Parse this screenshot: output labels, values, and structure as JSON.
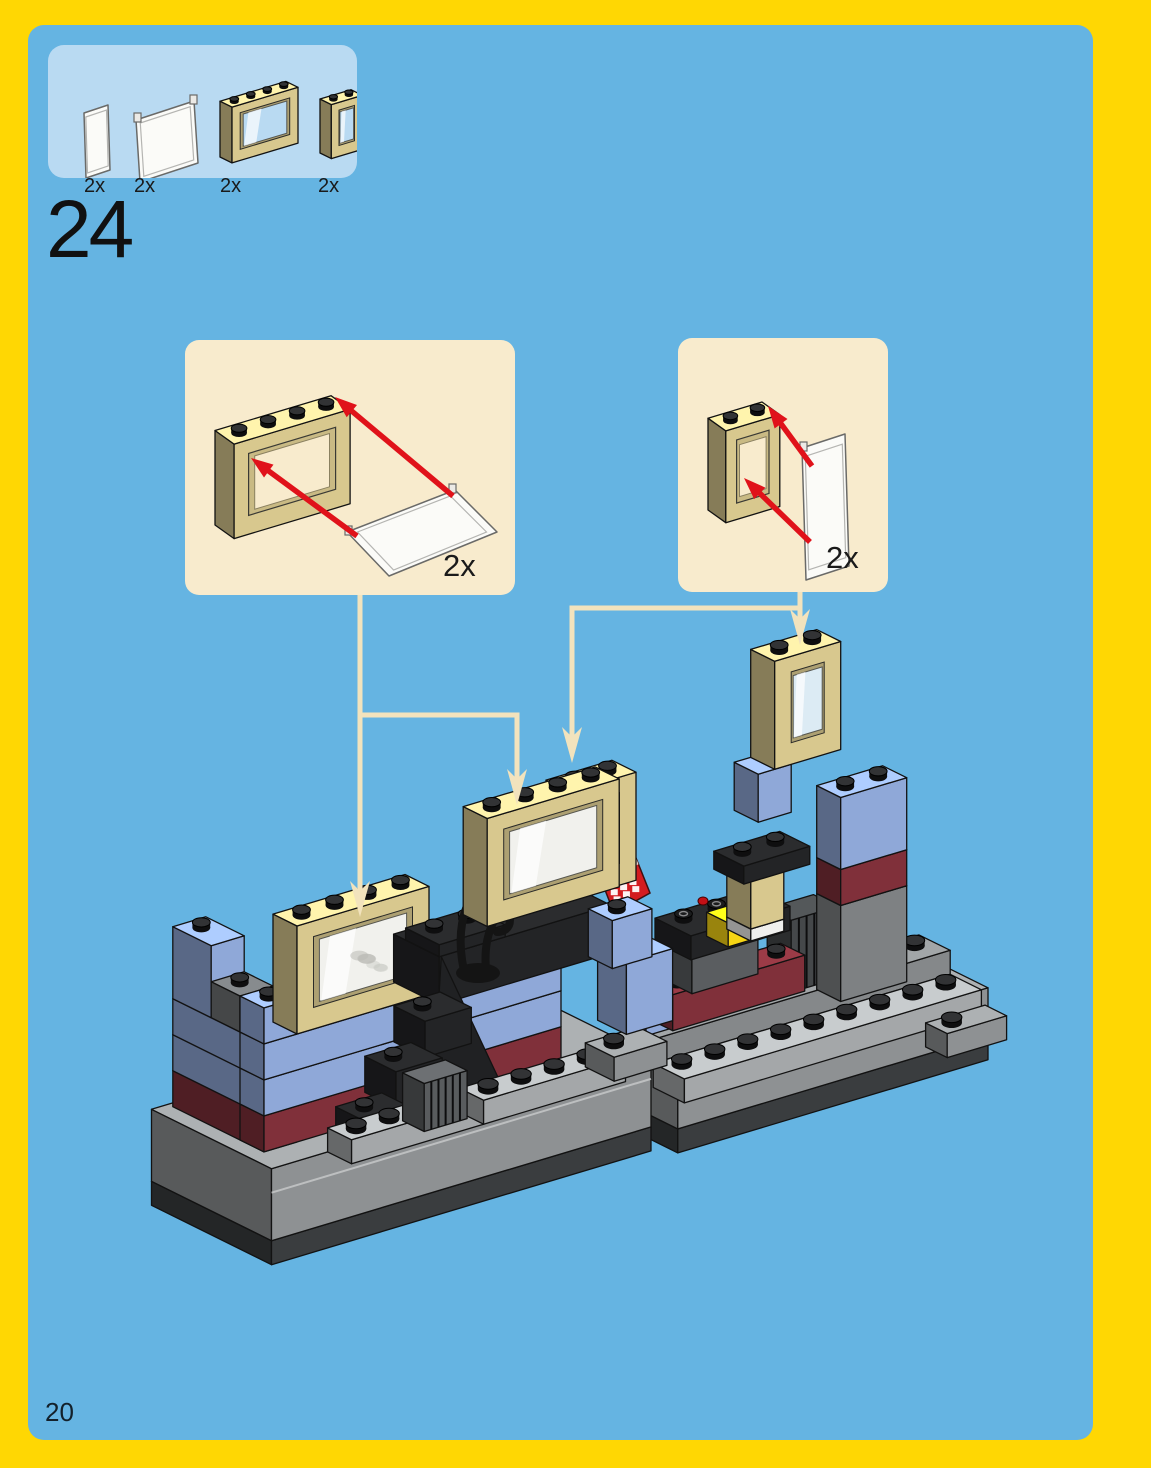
{
  "step_number": "24",
  "page_number": "20",
  "parts_box": {
    "items": [
      {
        "name": "glass-pane-1x2x3",
        "qty": "2x"
      },
      {
        "name": "glass-pane-1x4x3",
        "qty": "2x"
      },
      {
        "name": "window-frame-1x4x3",
        "qty": "2x"
      },
      {
        "name": "window-frame-1x2x3",
        "qty": "2x"
      }
    ]
  },
  "callouts": [
    {
      "name": "window-1x4x3-with-glass-subassembly",
      "qty": "2x"
    },
    {
      "name": "window-1x2x3-with-glass-subassembly",
      "qty": "2x"
    }
  ],
  "colors": {
    "page_border": "#ffd703",
    "page_bg": "#65b4e2",
    "parts_box_bg": "#b9daf2",
    "callout_bg": "#f8ebcd",
    "connector": "#f2e3bd",
    "arrow_red": "#e0121a",
    "tan": "#d8c88e",
    "brick_blue": "#8fa8d8",
    "dark_red": "#80303a",
    "gray": "#8e9193",
    "light_gray": "#a4a7a9",
    "dark_gray": "#55585a",
    "black": "#232426",
    "yellow": "#f6d515",
    "glass": "#f1f1ed",
    "glass_blue": "#dcebf4",
    "white": "#efefed",
    "red": "#d31c20"
  }
}
